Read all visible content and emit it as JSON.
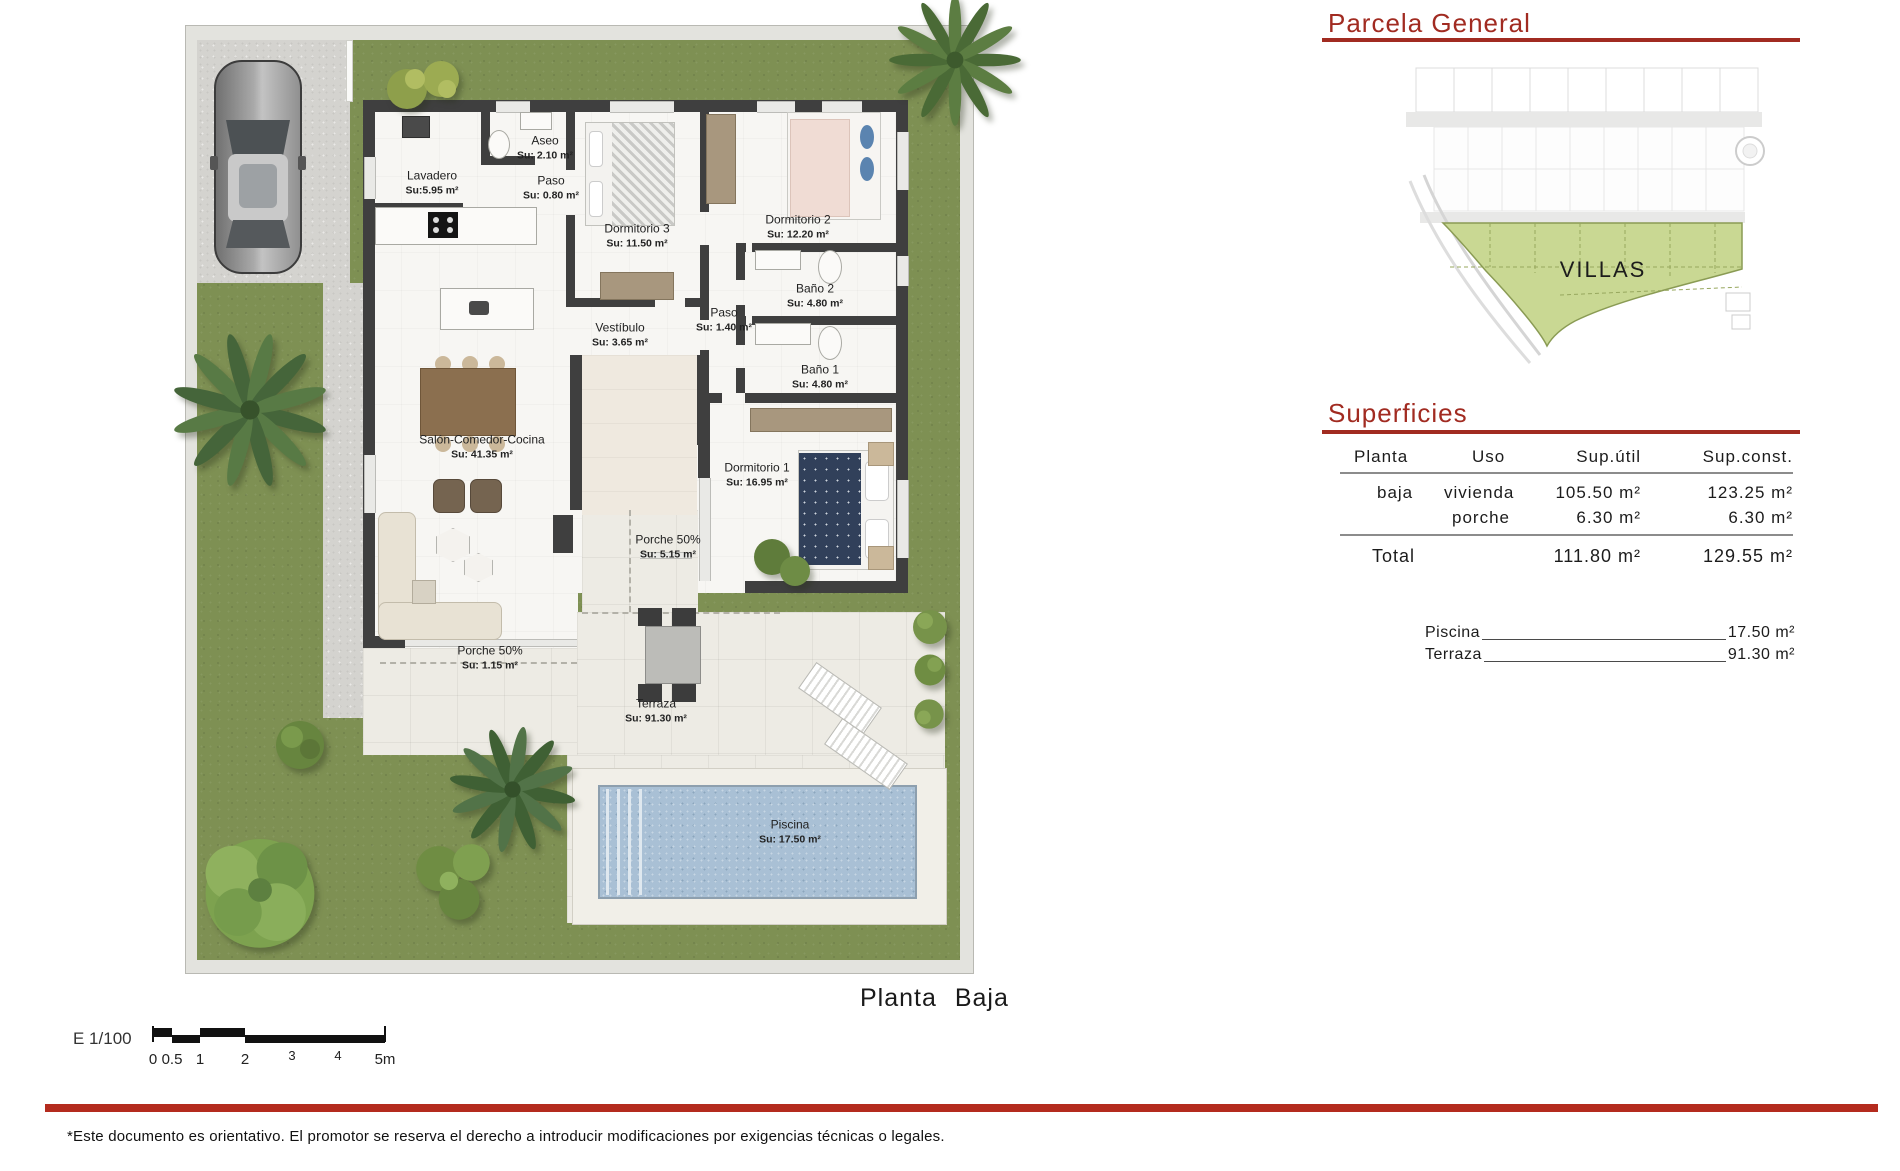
{
  "page": {
    "planta_label": "Planta Baja",
    "disclaimer": "*Este documento es orientativo. El promotor se reserva el derecho a introducir modificaciones por exigencias técnicas o legales."
  },
  "floorplan": {
    "rooms": [
      {
        "name": "Lavadero",
        "area": "Su:5.95 m²"
      },
      {
        "name": "Aseo",
        "area": "Su: 2.10 m²"
      },
      {
        "name": "Paso",
        "area": "Su: 0.80 m²"
      },
      {
        "name": "Dormitorio 3",
        "area": "Su: 11.50 m²"
      },
      {
        "name": "Dormitorio 2",
        "area": "Su: 12.20 m²"
      },
      {
        "name": "Baño 2",
        "area": "Su: 4.80 m²"
      },
      {
        "name": "Paso",
        "area": "Su: 1.40 m²"
      },
      {
        "name": "Baño 1",
        "area": "Su: 4.80 m²"
      },
      {
        "name": "Vestíbulo",
        "area": "Su: 3.65 m²"
      },
      {
        "name": "Salón-Comedor-Cocina",
        "area": "Su: 41.35 m²"
      },
      {
        "name": "Dormitorio 1",
        "area": "Su: 16.95 m²"
      },
      {
        "name": "Porche 50%",
        "area": "Su: 5.15 m²"
      },
      {
        "name": "Porche 50%",
        "area": "Su: 1.15 m²"
      },
      {
        "name": "Terraza",
        "area": "Su: 91.30 m²"
      },
      {
        "name": "Piscina",
        "area": "Su: 17.50 m²"
      }
    ],
    "scalebar": {
      "scale_label": "E 1/100",
      "ticks": [
        "0",
        "0.5",
        "1",
        "2",
        "3",
        "4",
        "5m"
      ]
    }
  },
  "parcela": {
    "title": "Parcela General",
    "zone_label": "VILLAS"
  },
  "superficies": {
    "title": "Superficies",
    "headers": [
      "Planta",
      "Uso",
      "Sup.útil",
      "Sup.const."
    ],
    "rows": [
      {
        "planta": "baja",
        "uso": "vivienda",
        "util": "105.50 m²",
        "const": "123.25 m²"
      },
      {
        "planta": "",
        "uso": "porche",
        "util": "6.30 m²",
        "const": "6.30 m²"
      }
    ],
    "total": {
      "label": "Total",
      "util": "111.80 m²",
      "const": "129.55 m²"
    },
    "extras": [
      {
        "label": "Piscina",
        "value": "17.50 m²"
      },
      {
        "label": "Terraza",
        "value": "91.30 m²"
      }
    ]
  }
}
